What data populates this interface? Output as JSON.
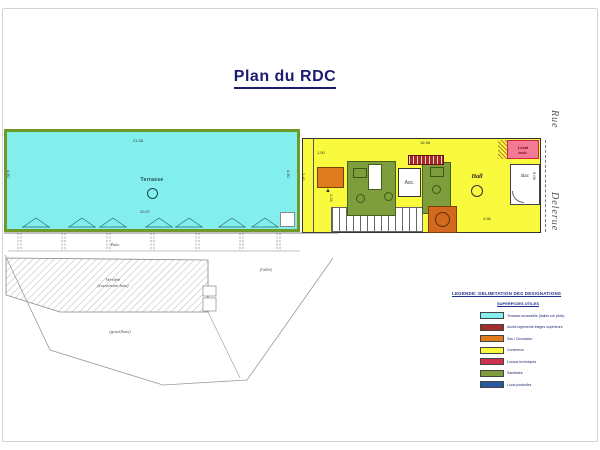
{
  "page": {
    "title": "Plan du RDC"
  },
  "street": {
    "word1": "Rue",
    "word2": "Delerue"
  },
  "terrace": {
    "label": "Terrasse"
  },
  "building": {
    "hall_label": "Hall",
    "elevator_label": "Asc.",
    "local_tech_line1": "Local",
    "local_tech_line2": "tech.",
    "store_label": "Bac"
  },
  "site": {
    "walkway_label": "Patio",
    "glass_roof_line1": "Verrière",
    "glass_roof_line2": "(couverture bois)",
    "gravel_label": "(gravillons)",
    "alley_label": "(l'allée)"
  },
  "dims": [
    {
      "text": "21.36",
      "x": 133,
      "y": 138,
      "rot": false
    },
    {
      "text": "20.97",
      "x": 140,
      "y": 209,
      "rot": false
    },
    {
      "text": "4.90",
      "x": 6,
      "y": 170,
      "rot": true
    },
    {
      "text": "4.90",
      "x": 286,
      "y": 170,
      "rot": true
    },
    {
      "text": "16.98",
      "x": 420,
      "y": 140,
      "rot": false
    },
    {
      "text": "4.56",
      "x": 483,
      "y": 216,
      "rot": false
    },
    {
      "text": "3.40",
      "x": 301,
      "y": 173,
      "rot": true
    },
    {
      "text": "1.50",
      "x": 317,
      "y": 150,
      "rot": false
    },
    {
      "text": "2.04",
      "x": 329,
      "y": 194,
      "rot": true
    },
    {
      "text": "5.08",
      "x": 532,
      "y": 172,
      "rot": true
    }
  ],
  "legend": {
    "title": "LEGENDE: DELIMITATION DES DESIGNATIONS",
    "subtitle": "SUPERFICIES UTILES",
    "items": [
      {
        "color": "#86efef",
        "label": "Terrasse accessible (dalles sur plots)"
      },
      {
        "color": "#a03028",
        "label": "Accès logements étages supérieurs"
      },
      {
        "color": "#e07b1e",
        "label": "Sas / Circulation"
      },
      {
        "color": "#f9f93d",
        "label": "Commerce"
      },
      {
        "color": "#d03050",
        "label": "Locaux techniques"
      },
      {
        "color": "#7e9d3d",
        "label": "Sanitaires"
      },
      {
        "color": "#2858a0",
        "label": "Local poubelles"
      }
    ]
  },
  "colors": {
    "title": "#1c1c6e",
    "terrace_fill": "#82efee",
    "terrace_border": "#6f9a28",
    "building_fill": "#f9f93d",
    "local_tech_fill": "#f27a95"
  }
}
